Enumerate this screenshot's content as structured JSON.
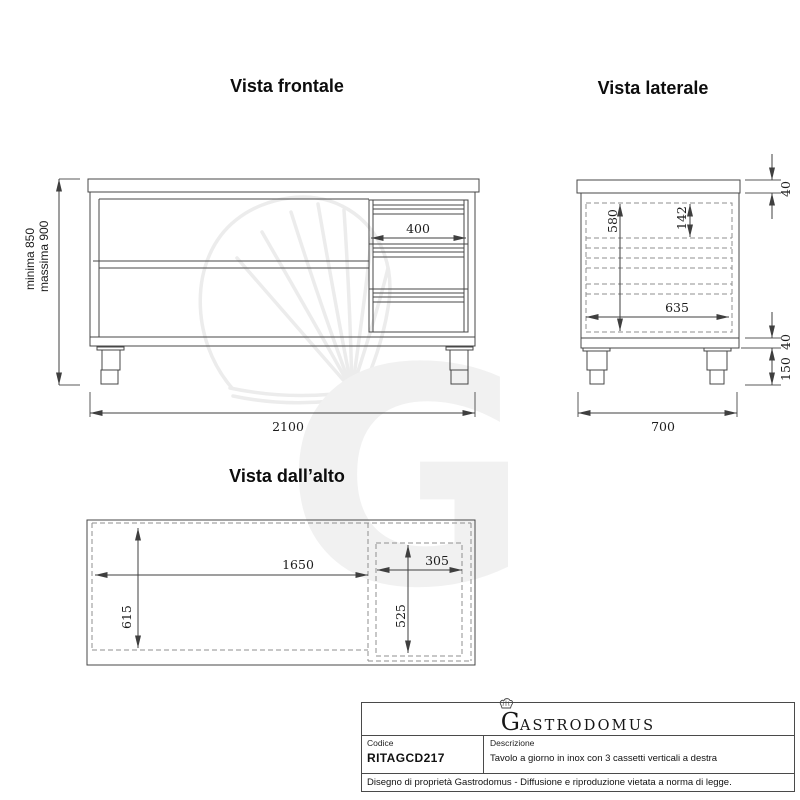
{
  "front": {
    "title": "Vista frontale",
    "dim_drawer_width": "400",
    "dim_total_width": "2100",
    "dim_height_min": "minima 850",
    "dim_height_max": "massima 900"
  },
  "side": {
    "title": "Vista laterale",
    "dim_top_thickness": "40",
    "dim_inner_height": "580",
    "dim_drawer_height": "142",
    "dim_inner_depth": "635",
    "dim_plinth_height": "40",
    "dim_leg_height": "150",
    "dim_total_depth": "700"
  },
  "top": {
    "title": "Vista dall’alto",
    "dim_open_width": "1650",
    "dim_open_depth": "615",
    "dim_drawer_width": "305",
    "dim_drawer_depth": "525"
  },
  "title_block": {
    "brand_initial": "G",
    "brand_rest": "ASTRODOMUS",
    "code_label": "Codice",
    "code_value": "RITAGCD217",
    "description_label": "Descrizione",
    "description_value": "Tavolo a giorno in inox con 3 cassetti verticali a destra",
    "footer": "Disegno di proprietà Gastrodomus -  Diffusione e riproduzione vietata a norma di legge."
  },
  "watermark": {
    "letter": "G"
  },
  "colors": {
    "line": "#474747",
    "dashed_line": "#8f8f8f",
    "text": "#1c1c1c",
    "watermark": "#f1f1f1"
  }
}
